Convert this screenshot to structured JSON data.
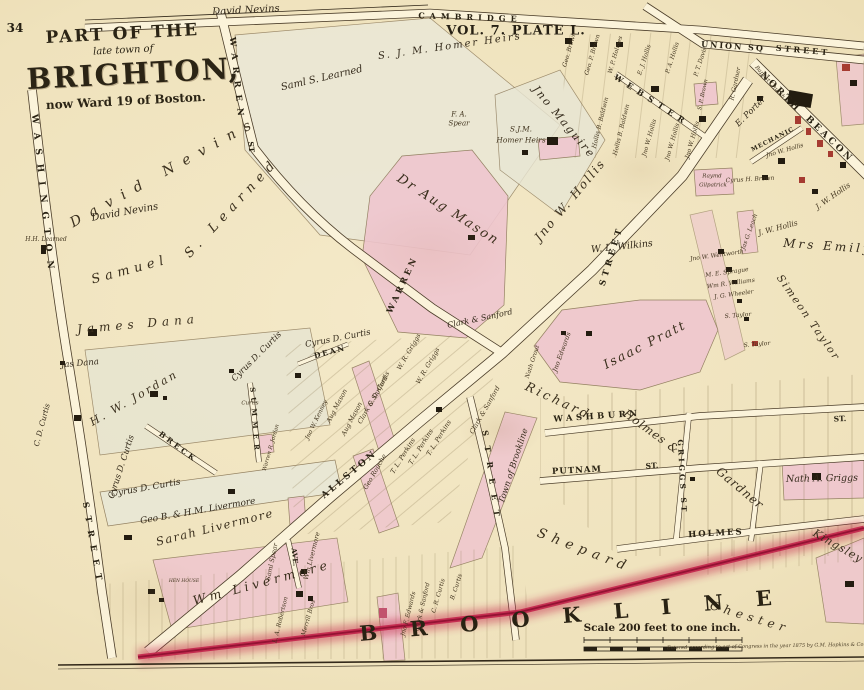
{
  "colors": {
    "paper": "#f1e5c3",
    "ink": "#2e2817",
    "parcel_pink": "#efc6cf",
    "boundary_crimson": "#c2234a",
    "road_fill": "#fbf3da",
    "building_black": "#231c10",
    "building_red": "#a63b31"
  },
  "title": {
    "part_of_the": "PART OF THE",
    "late_town_of": "late town of",
    "brighton": "BRIGHTON,",
    "ward": "now Ward 19 of Boston."
  },
  "labels": [
    {
      "t": "34",
      "x": 15,
      "y": 28,
      "s": 12,
      "cls": "plate"
    },
    {
      "t": "VOL. 7.  PLATE L.",
      "x": 516,
      "y": 31,
      "s": 13,
      "ls": 1,
      "cls": "plate"
    },
    {
      "t": "CAMBRIDGE",
      "x": 470,
      "y": 17,
      "r": 2,
      "s": 8,
      "ls": 5,
      "cls": "street"
    },
    {
      "t": "David Nevins",
      "x": 246,
      "y": 11,
      "r": -3,
      "s": 10,
      "cls": "owner"
    },
    {
      "t": "UNION SQ",
      "x": 733,
      "y": 46,
      "r": 4,
      "s": 8,
      "ls": 2,
      "cls": "street"
    },
    {
      "t": "STREET",
      "x": 803,
      "y": 50,
      "r": 5,
      "s": 8,
      "ls": 3,
      "cls": "street"
    },
    {
      "t": "NORTH",
      "x": 780,
      "y": 93,
      "r": 45,
      "s": 9,
      "ls": 3,
      "cls": "street"
    },
    {
      "t": "BEACON",
      "x": 829,
      "y": 140,
      "r": 44,
      "s": 9,
      "ls": 3,
      "cls": "street"
    },
    {
      "t": "MECHANIC",
      "x": 773,
      "y": 140,
      "r": -27,
      "s": 6,
      "ls": 1,
      "cls": "street"
    },
    {
      "t": "WEBSTER",
      "x": 652,
      "y": 100,
      "r": 33,
      "s": 8,
      "ls": 6,
      "cls": "street"
    },
    {
      "t": "WARREN",
      "x": 236,
      "y": 80,
      "r": 84,
      "s": 8.5,
      "ls": 7,
      "cls": "street"
    },
    {
      "t": "ST",
      "x": 251,
      "y": 147,
      "r": 84,
      "s": 7.5,
      "cls": "street"
    },
    {
      "t": "WARREN",
      "x": 403,
      "y": 285,
      "r": -65,
      "s": 8.5,
      "ls": 3,
      "cls": "street"
    },
    {
      "t": "WASHINGTON",
      "x": 42,
      "y": 196,
      "r": 84,
      "s": 9,
      "ls": 9,
      "cls": "street"
    },
    {
      "t": "STREET",
      "x": 92,
      "y": 545,
      "r": 80,
      "s": 8.5,
      "ls": 8,
      "cls": "street"
    },
    {
      "t": "ALLSTON",
      "x": 350,
      "y": 475,
      "r": -40,
      "s": 9,
      "ls": 3,
      "cls": "street"
    },
    {
      "t": "STREET",
      "x": 612,
      "y": 256,
      "r": -73,
      "s": 8.5,
      "ls": 4,
      "cls": "street"
    },
    {
      "t": "DEAN",
      "x": 330,
      "y": 352,
      "r": -15,
      "s": 7.5,
      "ls": 2,
      "cls": "street"
    },
    {
      "t": "SUMMER",
      "x": 255,
      "y": 421,
      "r": 86,
      "s": 7,
      "ls": 5,
      "cls": "street"
    },
    {
      "t": "BRECK",
      "x": 178,
      "y": 447,
      "r": 37,
      "s": 7.5,
      "ls": 3,
      "cls": "street"
    },
    {
      "t": "AVE.",
      "x": 295,
      "y": 557,
      "r": 84,
      "s": 7,
      "cls": "street"
    },
    {
      "t": "STREET",
      "x": 492,
      "y": 478,
      "r": 82,
      "s": 8,
      "ls": 10,
      "cls": "street"
    },
    {
      "t": "WASHBURN",
      "x": 597,
      "y": 417,
      "r": -4,
      "s": 8.5,
      "ls": 3.5,
      "cls": "street"
    },
    {
      "t": "ST.",
      "x": 840,
      "y": 419,
      "r": -2,
      "s": 7.5,
      "cls": "street"
    },
    {
      "t": "PUTNAM",
      "x": 577,
      "y": 471,
      "r": -3,
      "s": 8.5,
      "ls": 1,
      "cls": "street"
    },
    {
      "t": "ST.",
      "x": 652,
      "y": 466,
      "r": -3,
      "s": 7.5,
      "cls": "street"
    },
    {
      "t": "HOLMES",
      "x": 716,
      "y": 534,
      "r": -3,
      "s": 8.5,
      "ls": 2,
      "cls": "street"
    },
    {
      "t": "GRIGGS ST",
      "x": 682,
      "y": 477,
      "r": 87,
      "s": 7.5,
      "ls": 3,
      "cls": "street"
    },
    {
      "t": "David Nevins",
      "x": 165,
      "y": 172,
      "r": -29,
      "s": 14,
      "ls": 10,
      "cls": "owner-sp"
    },
    {
      "t": "David Nevins",
      "x": 125,
      "y": 213,
      "r": -10,
      "s": 10,
      "cls": "owner"
    },
    {
      "t": "S. Learned",
      "x": 232,
      "y": 208,
      "r": -47,
      "s": 13,
      "ls": 6,
      "cls": "owner-sp"
    },
    {
      "t": "Samuel",
      "x": 130,
      "y": 270,
      "r": -15,
      "s": 13,
      "ls": 5,
      "cls": "owner-sp"
    },
    {
      "t": "Saml S. Learned",
      "x": 322,
      "y": 79,
      "r": -13,
      "s": 10,
      "cls": "owner"
    },
    {
      "t": "H.H. Learned",
      "x": 46,
      "y": 240,
      "s": 6,
      "cls": "tiny"
    },
    {
      "t": "S. J. M. Homer Heirs",
      "x": 450,
      "y": 47,
      "r": -8,
      "s": 10,
      "ls": 2,
      "cls": "owner"
    },
    {
      "t": "S.J.M.",
      "x": 521,
      "y": 129,
      "s": 7.5,
      "cls": "tiny"
    },
    {
      "t": "Homer Heirs",
      "x": 521,
      "y": 140,
      "s": 7.5,
      "cls": "tiny"
    },
    {
      "t": "F. A.",
      "x": 459,
      "y": 115,
      "s": 7,
      "cls": "tiny"
    },
    {
      "t": "Spear",
      "x": 459,
      "y": 124,
      "s": 7,
      "cls": "tiny"
    },
    {
      "t": "Jno Maguire",
      "x": 564,
      "y": 122,
      "r": 50,
      "s": 11,
      "ls": 2,
      "cls": "owner"
    },
    {
      "t": "Dr Aug Mason",
      "x": 448,
      "y": 210,
      "r": 33,
      "s": 13,
      "ls": 2,
      "cls": "owner-sp"
    },
    {
      "t": "Jno W. Hollis",
      "x": 570,
      "y": 200,
      "r": -50,
      "s": 12,
      "ls": 2,
      "cls": "owner-sp"
    },
    {
      "t": "W. L. Wilkins",
      "x": 622,
      "y": 247,
      "r": -6,
      "s": 9.5,
      "cls": "owner"
    },
    {
      "t": "E. Porter",
      "x": 751,
      "y": 112,
      "r": -45,
      "s": 8.5,
      "cls": "owner"
    },
    {
      "t": "Mrs Emily",
      "x": 828,
      "y": 246,
      "r": 4,
      "s": 12,
      "ls": 3,
      "cls": "owner"
    },
    {
      "t": "Simeon Taylor",
      "x": 808,
      "y": 318,
      "r": 55,
      "s": 10.5,
      "ls": 2,
      "cls": "owner-sp"
    },
    {
      "t": "Isaac Pratt",
      "x": 645,
      "y": 345,
      "r": -27,
      "s": 12.5,
      "ls": 2,
      "cls": "owner-sp"
    },
    {
      "t": "Richard",
      "x": 558,
      "y": 401,
      "r": 25,
      "s": 12.5,
      "ls": 3,
      "cls": "owner-sp"
    },
    {
      "t": "Holmes &",
      "x": 651,
      "y": 432,
      "r": 36,
      "s": 11.5,
      "ls": 1,
      "cls": "owner-sp"
    },
    {
      "t": "Gardner",
      "x": 740,
      "y": 488,
      "r": 40,
      "s": 12,
      "ls": 1,
      "cls": "owner-sp"
    },
    {
      "t": "Kingsley",
      "x": 838,
      "y": 546,
      "r": 30,
      "s": 11,
      "ls": 1,
      "cls": "owner-sp"
    },
    {
      "t": "Shepard",
      "x": 584,
      "y": 551,
      "r": 21,
      "s": 13.5,
      "ls": 6,
      "cls": "owner-sp"
    },
    {
      "t": "Chester",
      "x": 750,
      "y": 617,
      "r": 17,
      "s": 12,
      "ls": 5,
      "cls": "owner-sp"
    },
    {
      "t": "Town of Brookline",
      "x": 514,
      "y": 466,
      "r": -72,
      "s": 8.5,
      "cls": "owner"
    },
    {
      "t": "James Dana",
      "x": 138,
      "y": 324,
      "r": -5,
      "s": 12,
      "ls": 5,
      "cls": "owner-sp"
    },
    {
      "t": "Jas Dana",
      "x": 80,
      "y": 364,
      "r": -5,
      "s": 8.5,
      "cls": "owner"
    },
    {
      "t": "H. W. Jordan",
      "x": 134,
      "y": 398,
      "r": -30,
      "s": 11,
      "ls": 2.5,
      "cls": "owner-sp"
    },
    {
      "t": "Cyrus D. Curtis",
      "x": 338,
      "y": 339,
      "r": -11,
      "s": 8.5,
      "cls": "owner"
    },
    {
      "t": "Cyrus D. Curtis",
      "x": 257,
      "y": 357,
      "r": -45,
      "s": 8.5,
      "cls": "owner"
    },
    {
      "t": "Cyrus D. Curtis",
      "x": 122,
      "y": 467,
      "r": -72,
      "s": 8.5,
      "cls": "owner"
    },
    {
      "t": "C. D. Curtis",
      "x": 42,
      "y": 425,
      "r": -75,
      "s": 7.5,
      "cls": "owner"
    },
    {
      "t": "Cyrus D. Curtis",
      "x": 146,
      "y": 489,
      "r": -10,
      "s": 9,
      "cls": "owner"
    },
    {
      "t": "Geo B. & H.M. Livermore",
      "x": 198,
      "y": 512,
      "r": -10,
      "s": 9,
      "cls": "owner"
    },
    {
      "t": "Sarah Livermore",
      "x": 215,
      "y": 528,
      "r": -14,
      "s": 11.5,
      "ls": 1.5,
      "cls": "owner-sp"
    },
    {
      "t": "Wm Livermore",
      "x": 262,
      "y": 583,
      "r": -15,
      "s": 12.5,
      "ls": 4,
      "cls": "owner-sp"
    },
    {
      "t": "HEN HOUSE",
      "x": 184,
      "y": 582,
      "s": 4.5,
      "cls": "tiny"
    },
    {
      "t": "Saml Spear",
      "x": 272,
      "y": 562,
      "r": -78,
      "s": 6.5,
      "cls": "tiny"
    },
    {
      "t": "Wm Livermore",
      "x": 312,
      "y": 556,
      "r": -76,
      "s": 6.5,
      "cls": "tiny"
    },
    {
      "t": "Clark & Sanford",
      "x": 480,
      "y": 319,
      "r": -12,
      "s": 8,
      "cls": "owner"
    },
    {
      "t": "Clark & Sanford",
      "x": 373,
      "y": 400,
      "r": -60,
      "s": 6.5,
      "cls": "tiny"
    },
    {
      "t": "Clark & Sanford",
      "x": 485,
      "y": 410,
      "r": -60,
      "s": 6.5,
      "cls": "tiny"
    },
    {
      "t": "W. R. Griggs",
      "x": 409,
      "y": 352,
      "r": -60,
      "s": 6.5,
      "cls": "tiny"
    },
    {
      "t": "W. R. Griggs",
      "x": 428,
      "y": 366,
      "r": -60,
      "s": 6.5,
      "cls": "tiny"
    },
    {
      "t": "Aug Mason",
      "x": 337,
      "y": 406,
      "r": -62,
      "s": 6.5,
      "cls": "tiny"
    },
    {
      "t": "Aug Mason",
      "x": 352,
      "y": 419,
      "r": -62,
      "s": 6.5,
      "cls": "tiny"
    },
    {
      "t": "Jno W. Kenney",
      "x": 317,
      "y": 420,
      "r": -64,
      "s": 6,
      "cls": "tiny"
    },
    {
      "t": "C. D. Curtis",
      "x": 379,
      "y": 389,
      "r": -62,
      "s": 6.5,
      "cls": "tiny"
    },
    {
      "t": "T. L. Perkins",
      "x": 403,
      "y": 456,
      "r": -58,
      "s": 6.5,
      "cls": "tiny"
    },
    {
      "t": "T. L. Perkins",
      "x": 421,
      "y": 447,
      "r": -58,
      "s": 6.5,
      "cls": "tiny"
    },
    {
      "t": "T. L. Perkins",
      "x": 439,
      "y": 438,
      "r": -58,
      "s": 6.5,
      "cls": "tiny"
    },
    {
      "t": "Geo Rouche",
      "x": 375,
      "y": 472,
      "r": -60,
      "s": 6.5,
      "cls": "tiny"
    },
    {
      "t": "Jno Edwards",
      "x": 562,
      "y": 352,
      "r": -70,
      "s": 6.5,
      "cls": "tiny"
    },
    {
      "t": "Nath Grout",
      "x": 533,
      "y": 362,
      "r": -72,
      "s": 6,
      "cls": "tiny"
    },
    {
      "t": "Nath A. Griggs",
      "x": 822,
      "y": 479,
      "r": -1,
      "s": 9.5,
      "cls": "owner"
    },
    {
      "t": "Jno F. Edwards",
      "x": 409,
      "y": 614,
      "r": -76,
      "s": 6,
      "cls": "tiny"
    },
    {
      "t": "Clark & Sanford",
      "x": 423,
      "y": 607,
      "r": -77,
      "s": 6,
      "cls": "tiny"
    },
    {
      "t": "C. R. Curtis",
      "x": 439,
      "y": 596,
      "r": -74,
      "s": 6,
      "cls": "tiny"
    },
    {
      "t": "B. Curtis",
      "x": 457,
      "y": 587,
      "r": -72,
      "s": 6,
      "cls": "tiny"
    },
    {
      "t": "Merrill Bros",
      "x": 309,
      "y": 618,
      "r": -74,
      "s": 6,
      "cls": "tiny"
    },
    {
      "t": "L. A. Robertson",
      "x": 281,
      "y": 620,
      "r": -76,
      "s": 6,
      "cls": "tiny"
    },
    {
      "t": "Warren R. Jordan",
      "x": 272,
      "y": 448,
      "r": -74,
      "s": 5.5,
      "cls": "tiny"
    },
    {
      "t": "Curtis",
      "x": 250,
      "y": 404,
      "s": 5.5,
      "cls": "tiny"
    },
    {
      "t": "Jno W. Wentworth",
      "x": 717,
      "y": 256,
      "r": -8,
      "s": 6,
      "cls": "tiny"
    },
    {
      "t": "M. E. Sprague",
      "x": 727,
      "y": 273,
      "r": -8,
      "s": 6,
      "cls": "tiny"
    },
    {
      "t": "Wm R. Williams",
      "x": 731,
      "y": 284,
      "r": -8,
      "s": 6,
      "cls": "tiny"
    },
    {
      "t": "J. G. Wheeler",
      "x": 734,
      "y": 295,
      "r": -8,
      "s": 6,
      "cls": "tiny"
    },
    {
      "t": "S. Taylor",
      "x": 738,
      "y": 316,
      "r": -5,
      "s": 6,
      "cls": "tiny"
    },
    {
      "t": "S. Taylor",
      "x": 757,
      "y": 345,
      "r": -5,
      "s": 6,
      "cls": "tiny"
    },
    {
      "t": "Jas G. Leach",
      "x": 750,
      "y": 232,
      "r": -70,
      "s": 6,
      "cls": "tiny"
    },
    {
      "t": "J. W. Hollis",
      "x": 833,
      "y": 196,
      "r": -35,
      "s": 7.5,
      "cls": "tiny"
    },
    {
      "t": "J. W. Hollis",
      "x": 778,
      "y": 228,
      "r": -15,
      "s": 7.5,
      "cls": "tiny"
    },
    {
      "t": "Cyrus H. Brown",
      "x": 750,
      "y": 180,
      "r": -3,
      "s": 6,
      "cls": "tiny"
    },
    {
      "t": "Raymd",
      "x": 712,
      "y": 177,
      "s": 5.5,
      "cls": "tiny"
    },
    {
      "t": "Gilpatrick",
      "x": 713,
      "y": 186,
      "s": 5.5,
      "cls": "tiny"
    },
    {
      "t": "Baptist Church",
      "x": 769,
      "y": 83,
      "r": 48,
      "s": 5.5,
      "cls": "tiny"
    },
    {
      "t": "R. Gardner",
      "x": 736,
      "y": 84,
      "r": -78,
      "s": 6,
      "cls": "tiny"
    },
    {
      "t": "S. P. Brown",
      "x": 704,
      "y": 95,
      "r": -78,
      "s": 5.5,
      "cls": "tiny"
    },
    {
      "t": "Geo. Brown",
      "x": 570,
      "y": 50,
      "r": -74,
      "s": 6,
      "cls": "tiny"
    },
    {
      "t": "Geo. P. Brown",
      "x": 593,
      "y": 55,
      "r": -74,
      "s": 6,
      "cls": "tiny"
    },
    {
      "t": "W. P. Holmes",
      "x": 616,
      "y": 55,
      "r": -74,
      "s": 6,
      "cls": "tiny"
    },
    {
      "t": "Hollis B. Baldwin",
      "x": 601,
      "y": 123,
      "r": -76,
      "s": 6,
      "cls": "tiny"
    },
    {
      "t": "Hollis B. Baldwin",
      "x": 622,
      "y": 130,
      "r": -76,
      "s": 6,
      "cls": "tiny"
    },
    {
      "t": "E. J. Hollis",
      "x": 645,
      "y": 60,
      "r": -72,
      "s": 6,
      "cls": "tiny"
    },
    {
      "t": "P. A. Hollis",
      "x": 673,
      "y": 58,
      "r": -72,
      "s": 6,
      "cls": "tiny"
    },
    {
      "t": "P. T. Davis",
      "x": 701,
      "y": 62,
      "r": -72,
      "s": 6,
      "cls": "tiny"
    },
    {
      "t": "Jno W. Hollis",
      "x": 650,
      "y": 138,
      "r": -74,
      "s": 6,
      "cls": "tiny"
    },
    {
      "t": "Jno W. Hollis",
      "x": 673,
      "y": 142,
      "r": -74,
      "s": 6,
      "cls": "tiny"
    },
    {
      "t": "Jno W. Hollis",
      "x": 693,
      "y": 140,
      "r": -74,
      "s": 6,
      "cls": "tiny"
    },
    {
      "t": "Jno W. Hollis",
      "x": 785,
      "y": 151,
      "r": -16,
      "s": 6,
      "cls": "tiny"
    },
    {
      "t": "BROOKLINE",
      "x": 582,
      "y": 614,
      "r": -5,
      "s": 21,
      "ls": 33,
      "cls": "boundary"
    },
    {
      "t": "Scale 200 feet to one inch.",
      "x": 662,
      "y": 628,
      "s": 10.5,
      "cls": "scale"
    },
    {
      "t": "Entered according to act of Congress in the year 1875 by G.M. Hopkins & Co.",
      "x": 766,
      "y": 647,
      "r": -1,
      "s": 5,
      "cls": "credit"
    }
  ]
}
